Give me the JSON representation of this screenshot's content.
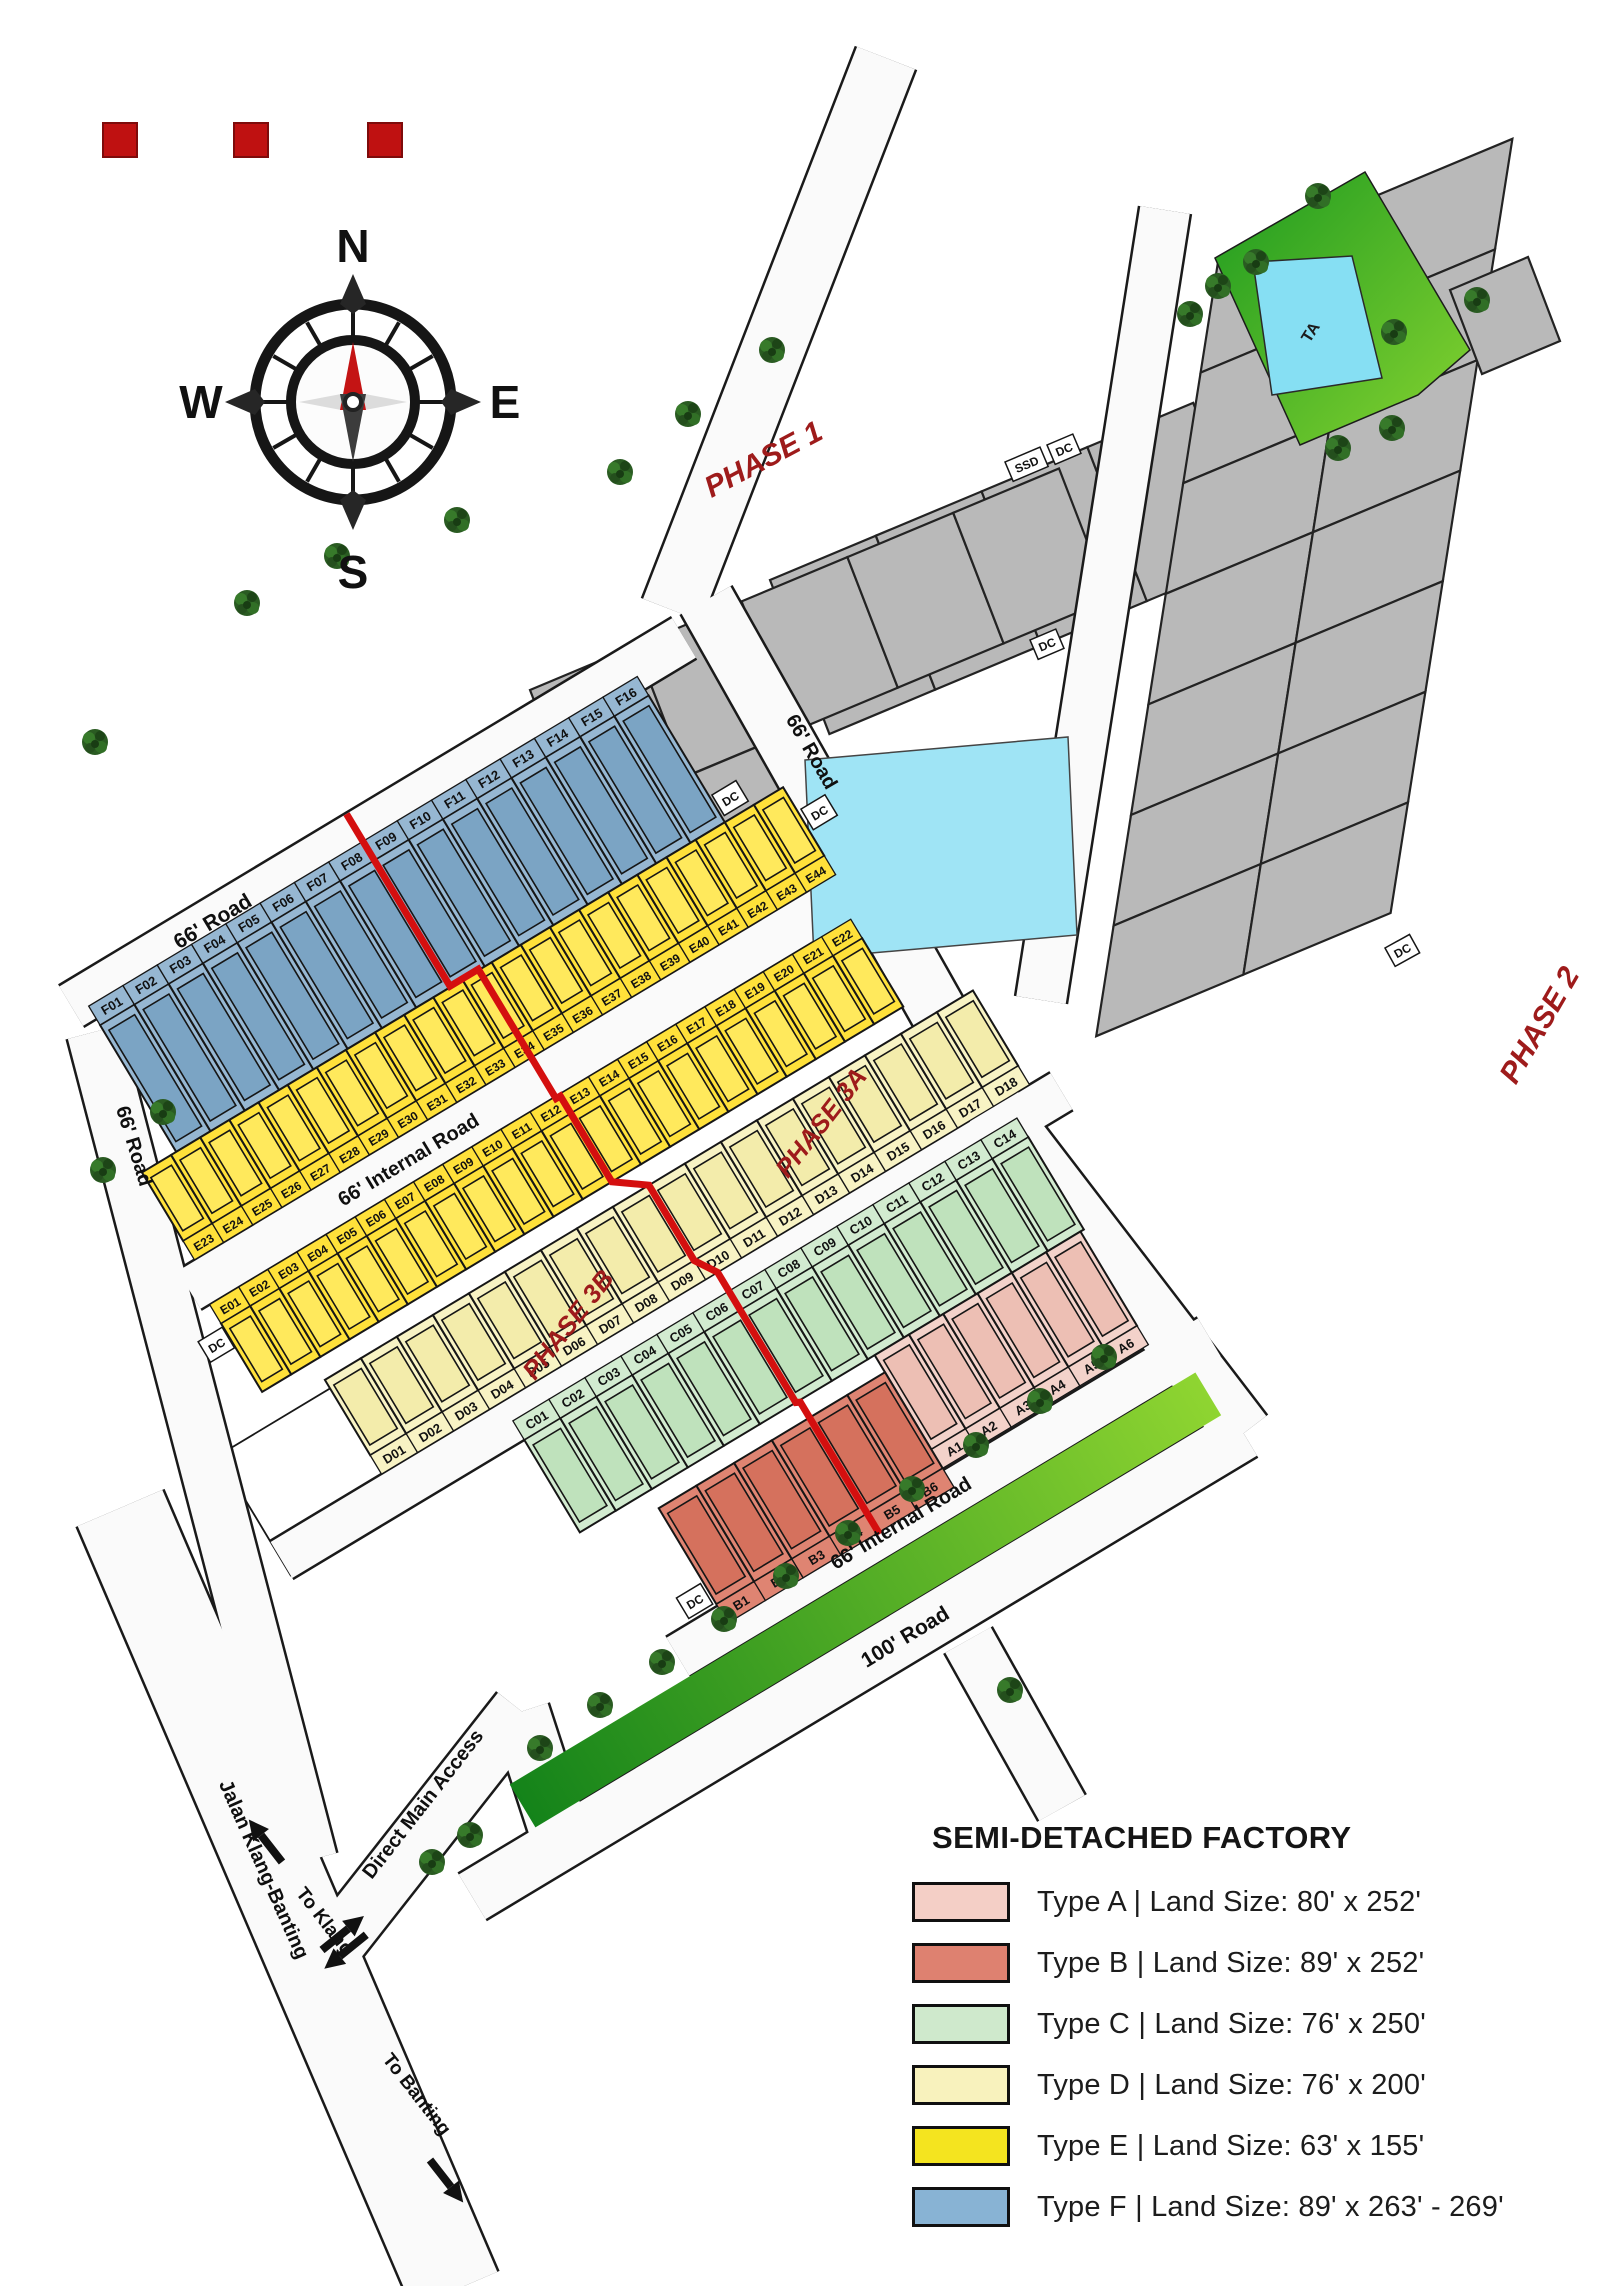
{
  "logo": {
    "square_color": "#bf1111",
    "square_count": 3
  },
  "compass": {
    "n": "N",
    "e": "E",
    "s": "S",
    "w": "W"
  },
  "phases": [
    {
      "id": "phase-1",
      "label": "PHASE 1"
    },
    {
      "id": "phase-2",
      "label": "PHASE 2"
    },
    {
      "id": "phase-3a",
      "label": "PHASE 3A"
    },
    {
      "id": "phase-3b",
      "label": "PHASE 3B"
    }
  ],
  "roads": [
    {
      "id": "road-66-main",
      "label": "66' Road"
    },
    {
      "id": "road-66-left",
      "label": "66' Road"
    },
    {
      "id": "road-66-east",
      "label": "66' Road"
    },
    {
      "id": "internal-road-1",
      "label": "66' Internal Road"
    },
    {
      "id": "internal-road-2",
      "label": "66' Internal Road"
    },
    {
      "id": "road-100",
      "label": "100' Road"
    },
    {
      "id": "direct-main-access",
      "label": "Direct Main Access"
    },
    {
      "id": "jalan-klang-banting",
      "label": "Jalan Klang-Banting"
    },
    {
      "id": "to-klang",
      "label": "To Klang"
    },
    {
      "id": "to-banting",
      "label": "To Banting"
    }
  ],
  "markers": {
    "dc": "DC",
    "ssd": "SSD",
    "ta": "TA"
  },
  "strips": {
    "F": {
      "type": "F",
      "color": "#96b7d2",
      "inner": "#7ba4c4",
      "labels": [
        "F01",
        "F02",
        "F03",
        "F04",
        "F05",
        "F06",
        "F07",
        "F08",
        "F09",
        "F10",
        "F11",
        "F12",
        "F13",
        "F14",
        "F15",
        "F16"
      ]
    },
    "E_upper": {
      "type": "E",
      "color": "#ffe13a",
      "inner": "#ffe95c",
      "labels": [
        "E23",
        "E24",
        "E25",
        "E26",
        "E27",
        "E28",
        "E29",
        "E30",
        "E31",
        "E32",
        "E33",
        "E34",
        "E35",
        "E36",
        "E37",
        "E38",
        "E39",
        "E40",
        "E41",
        "E42",
        "E43",
        "E44"
      ]
    },
    "E_lower": {
      "type": "E",
      "color": "#ffe13a",
      "inner": "#ffe95c",
      "labels": [
        "E01",
        "E02",
        "E03",
        "E04",
        "E05",
        "E06",
        "E07",
        "E08",
        "E09",
        "E10",
        "E11",
        "E12",
        "E13",
        "E14",
        "E15",
        "E16",
        "E17",
        "E18",
        "E19",
        "E20",
        "E21",
        "E22"
      ]
    },
    "D": {
      "type": "D",
      "color": "#f8f3c4",
      "inner": "#f3ecab",
      "labels": [
        "D01",
        "D02",
        "D03",
        "D04",
        "D05",
        "D06",
        "D07",
        "D08",
        "D09",
        "D10",
        "D11",
        "D12",
        "D13",
        "D14",
        "D15",
        "D16",
        "D17",
        "D18"
      ]
    },
    "C": {
      "type": "C",
      "color": "#d2ebd0",
      "inner": "#bfe2bc",
      "labels": [
        "C01",
        "C02",
        "C03",
        "C04",
        "C05",
        "C06",
        "C07",
        "C08",
        "C09",
        "C10",
        "C11",
        "C12",
        "C13",
        "C14"
      ]
    },
    "A": {
      "type": "A",
      "color": "#f3d2ca",
      "inner": "#edbfb4",
      "labels": [
        "A1",
        "A2",
        "A3",
        "A4",
        "A5",
        "A6"
      ]
    },
    "B": {
      "type": "B",
      "color": "#df8472",
      "inner": "#d5715d",
      "labels": [
        "B1",
        "B2",
        "B3",
        "B4",
        "B5",
        "B6"
      ]
    }
  },
  "legend": {
    "title": "SEMI-DETACHED FACTORY",
    "entries": [
      {
        "type": "A",
        "color": "#f4cfc6",
        "label": "Type A | Land Size: 80' x 252'"
      },
      {
        "type": "B",
        "color": "#de8170",
        "label": "Type B | Land Size: 89' x 252'"
      },
      {
        "type": "C",
        "color": "#cfe9cc",
        "label": "Type C | Land Size: 76' x 250'"
      },
      {
        "type": "D",
        "color": "#f8f2bd",
        "label": "Type D | Land Size: 76' x 200'"
      },
      {
        "type": "E",
        "color": "#f4e41f",
        "label": "Type E | Land Size: 63' x 155'"
      },
      {
        "type": "F",
        "color": "#88b3d4",
        "label": "Type F | Land Size: 89' x 263' - 269'"
      }
    ]
  }
}
